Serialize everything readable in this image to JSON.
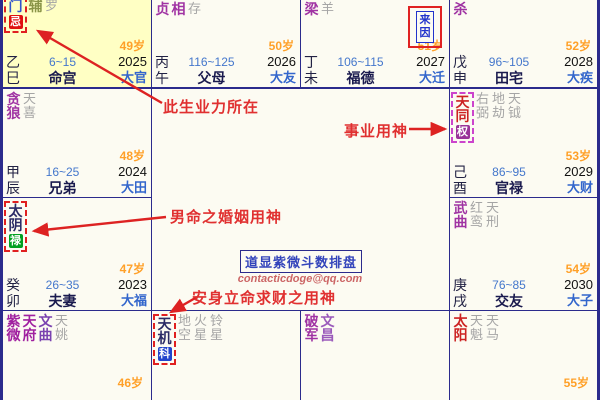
{
  "watermark": {
    "title": "道显紫微斗数排盘",
    "email": "contacticdoge@qq.com"
  },
  "annotations": {
    "karma": "此生业力所在",
    "career": "事业用神",
    "marriage": "男命之婚姻用神",
    "wealth": "安身立命求财之用神"
  },
  "colors": {
    "grid": "#2B2B8C",
    "highlight_cell": "#FFFFC4",
    "annotation_red": "#E03030",
    "hua_ji": "#E01010",
    "hua_quan": "#993399",
    "hua_lu": "#00A020",
    "hua_ke": "#2244CC"
  },
  "cells": [
    {
      "id": "si",
      "bg": "#FFFFC4",
      "stars": [
        {
          "text": "门",
          "color": "#3355CC",
          "badge": {
            "text": "忌",
            "bg": "#E01010"
          },
          "box": "#E02020"
        },
        {
          "text": "辅",
          "color": "#8A9447"
        },
        {
          "text": "罗",
          "minor": true
        }
      ],
      "age": "49岁",
      "stem": "乙",
      "branch": "巳",
      "range": "6~15",
      "palace": "命宫",
      "year": "2025",
      "daxian": "大官"
    },
    {
      "id": "wu",
      "stars": [
        {
          "text": "贞",
          "color": "#A033A3"
        },
        {
          "text": "相",
          "color": "#A033A3"
        },
        {
          "text": "存",
          "minor": true
        }
      ],
      "age": "50岁",
      "stem": "丙",
      "branch": "午",
      "range": "116~125",
      "palace": "父母",
      "year": "2026",
      "daxian": "大友"
    },
    {
      "id": "wei",
      "stars": [
        {
          "text": "梁",
          "color": "#A033A3"
        },
        {
          "text": "羊",
          "minor": true
        }
      ],
      "laiyin": "来因",
      "age": "51岁",
      "stem": "丁",
      "branch": "未",
      "range": "106~115",
      "palace": "福德",
      "year": "2027",
      "daxian": "大迁"
    },
    {
      "id": "shen",
      "stars": [
        {
          "text": "杀",
          "color": "#A033A3"
        }
      ],
      "age": "52岁",
      "stem": "戊",
      "branch": "申",
      "range": "96~105",
      "palace": "田宅",
      "year": "2028",
      "daxian": "大疾"
    },
    {
      "id": "chen",
      "stars": [
        {
          "text": "贪狼",
          "color": "#A033A3"
        },
        {
          "text": "天喜",
          "minor": true
        }
      ],
      "age": "48岁",
      "stem": "甲",
      "branch": "辰",
      "range": "16~25",
      "palace": "兄弟",
      "year": "2024",
      "daxian": "大田"
    },
    {
      "id": "you",
      "stars": [
        {
          "text": "天同",
          "color": "#CC2222",
          "badge": {
            "text": "权",
            "bg": "#993399"
          },
          "box": "#CC44CC"
        },
        {
          "text": "右弼",
          "minor": true
        },
        {
          "text": "地劫",
          "minor": true
        },
        {
          "text": "天钺",
          "minor": true
        }
      ],
      "age": "53岁",
      "stem": "己",
      "branch": "酉",
      "range": "86~95",
      "palace": "官禄",
      "year": "2029",
      "daxian": "大财"
    },
    {
      "id": "mao",
      "stars": [
        {
          "text": "太阴",
          "color": "#2B2B66",
          "badge": {
            "text": "禄",
            "bg": "#00A020"
          },
          "box": "#E02020"
        }
      ],
      "age": "47岁",
      "stem": "癸",
      "branch": "卯",
      "range": "26~35",
      "palace": "夫妻",
      "year": "2023",
      "daxian": "大福"
    },
    {
      "id": "xu",
      "stars": [
        {
          "text": "武曲",
          "color": "#A033A3"
        },
        {
          "text": "红鸾",
          "minor": true
        },
        {
          "text": "天刑",
          "minor": true
        }
      ],
      "age": "54岁",
      "stem": "庚",
      "branch": "戌",
      "range": "76~85",
      "palace": "交友",
      "year": "2030",
      "daxian": "大子"
    },
    {
      "id": "yin",
      "stars": [
        {
          "text": "紫微",
          "color": "#A020A0"
        },
        {
          "text": "天府",
          "color": "#A020A0"
        },
        {
          "text": "文曲",
          "color": "#7A42B0"
        },
        {
          "text": "天姚",
          "minor": true
        }
      ],
      "age": "46岁"
    },
    {
      "id": "chou",
      "stars": [
        {
          "text": "天机",
          "color": "#2B2B66",
          "badge": {
            "text": "科",
            "bg": "#2244CC"
          },
          "box": "#E02020"
        },
        {
          "text": "地空",
          "minor": true
        },
        {
          "text": "火星",
          "minor": true
        },
        {
          "text": "铃星",
          "minor": true
        }
      ]
    },
    {
      "id": "zi",
      "stars": [
        {
          "text": "破军",
          "color": "#A033A3"
        },
        {
          "text": "文昌",
          "color": "#9A5ABB"
        }
      ]
    },
    {
      "id": "hai",
      "stars": [
        {
          "text": "太阳",
          "color": "#CC2222"
        },
        {
          "text": "天魁",
          "minor": true
        },
        {
          "text": "天马",
          "minor": true
        }
      ],
      "age": "55岁"
    }
  ]
}
